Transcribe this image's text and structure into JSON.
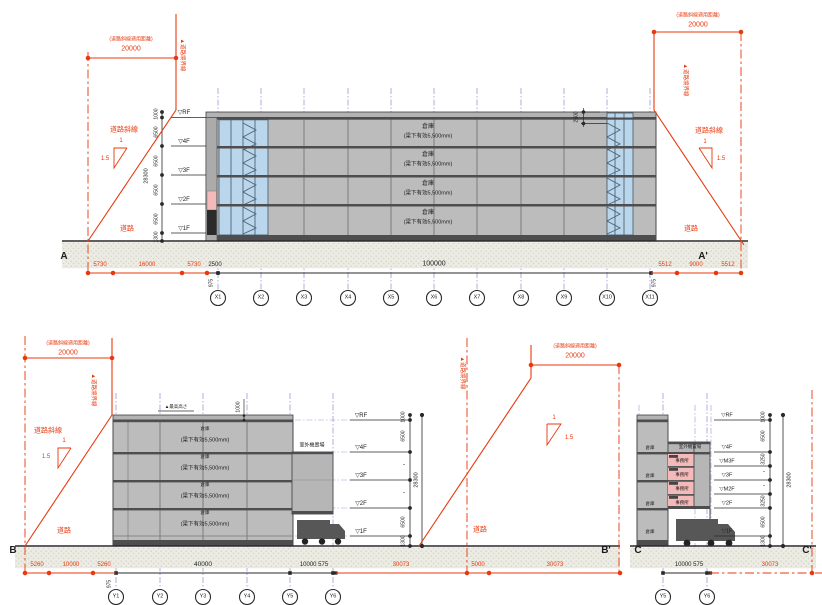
{
  "drawing": {
    "red": {
      "applicable_distance": "(道路斜線適用距離)",
      "distance_value": "20000",
      "road_boundary": "▲道路境界線",
      "road_slope": "道路斜線",
      "ratio_top": "1",
      "ratio_side": "1.5",
      "road": "道路"
    },
    "building": {
      "warehouse": "倉庫",
      "beam_note": "(梁下有効5,500mm)",
      "office": "事務所",
      "outdoor_unit": "室外機置場",
      "max_height": "▲最高高さ"
    },
    "section_a": {
      "start": "A",
      "end": "A'",
      "grid": [
        "X1",
        "X2",
        "X3",
        "X4",
        "X5",
        "X6",
        "X7",
        "X8",
        "X9",
        "X10",
        "X11"
      ],
      "floors": [
        "▽RF",
        "▽4F",
        "▽3F",
        "▽2F",
        "▽1F"
      ],
      "heights": [
        "1000",
        "6500",
        "6500",
        "6500",
        "6500",
        "1300"
      ],
      "total_height": "28300",
      "parapet_dim": "2500",
      "span": "100000",
      "left_dims": [
        "5730",
        "16000",
        "5730"
      ],
      "offset_dim": "2500",
      "offset_small": "975",
      "right_dims": [
        "5512",
        "9000",
        "5512"
      ]
    },
    "section_b": {
      "start": "B",
      "end": "B'",
      "grid": [
        "Y1",
        "Y2",
        "Y3",
        "Y4",
        "Y5",
        "Y6"
      ],
      "floors": [
        "▽RF",
        "▽4F",
        "▽3F",
        "▽2F",
        "▽1F"
      ],
      "heights": [
        "1000",
        "6500",
        "・",
        "・",
        "6500",
        "1300"
      ],
      "total_height": "28300",
      "roof_dim": "1000",
      "left_dims": [
        "5260",
        "10000",
        "5260"
      ],
      "span": "40000",
      "span_right": "10000 575",
      "offset_small": "975",
      "road_dims": [
        "30073",
        "5000",
        "30073"
      ]
    },
    "section_c": {
      "start": "C",
      "end": "C'",
      "grid": [
        "Y5",
        "Y6"
      ],
      "floors": [
        "▽RF",
        "▽4F",
        "▽M3F",
        "▽3F",
        "▽M2F",
        "▽2F",
        "▽1F"
      ],
      "heights": [
        "1000",
        "6500",
        "3250",
        "・",
        "・",
        "3250",
        "6500",
        "1300"
      ],
      "total_height": "28300",
      "span": "10000 575",
      "road_dim": "30073"
    }
  }
}
